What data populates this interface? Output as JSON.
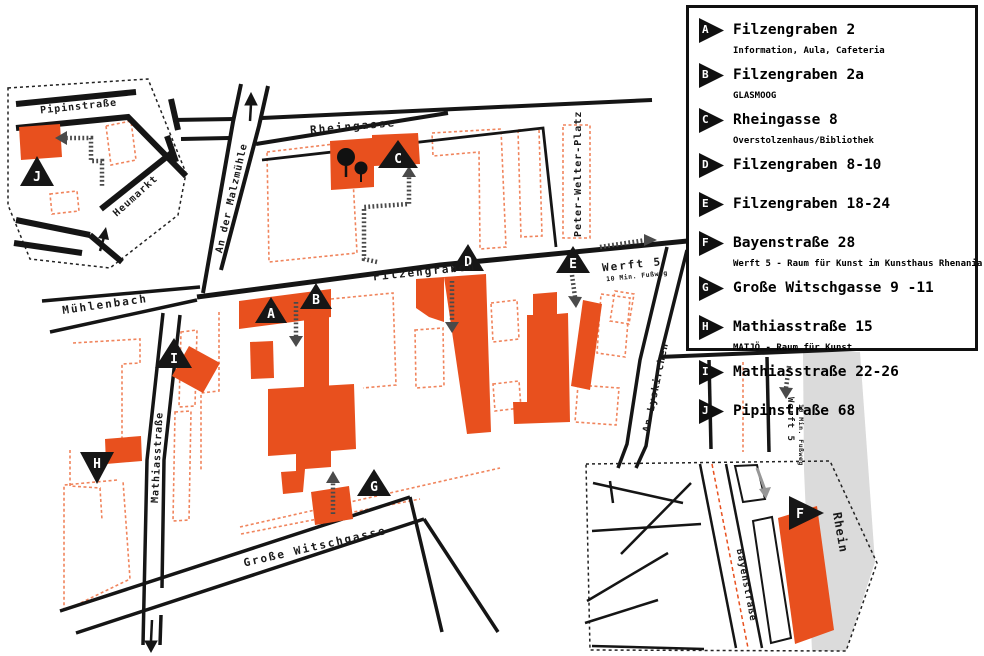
{
  "legend": {
    "items": [
      {
        "letter": "A",
        "title": "Filzengraben 2",
        "subtitle": "Information, Aula, Cafeteria"
      },
      {
        "letter": "B",
        "title": "Filzengraben 2a",
        "subtitle": "GLASMOOG"
      },
      {
        "letter": "C",
        "title": "Rheingasse 8",
        "subtitle": "Overstolzenhaus/Bibliothek"
      },
      {
        "letter": "D",
        "title": "Filzengraben 8-10",
        "subtitle": ""
      },
      {
        "letter": "E",
        "title": "Filzengraben 18-24",
        "subtitle": ""
      },
      {
        "letter": "F",
        "title": "Bayenstraße 28",
        "subtitle": "Werft 5 - Raum für Kunst im Kunsthaus Rhenania"
      },
      {
        "letter": "G",
        "title": "Große Witschgasse 9 -11",
        "subtitle": ""
      },
      {
        "letter": "H",
        "title": "Mathiasstraße 15",
        "subtitle": "MATJÖ - Raum für Kunst"
      },
      {
        "letter": "I",
        "title": "Mathiasstraße 22-26",
        "subtitle": ""
      },
      {
        "letter": "J",
        "title": "Pipinstraße 68",
        "subtitle": ""
      }
    ]
  },
  "map": {
    "streets": {
      "rheingasse": "Rheingasse",
      "an_der_malzmuehle": "An der Malzmühle",
      "filzengraben": "Filzengraben",
      "muehlenbach": "Mühlenbach",
      "mathiasstrasse": "Mathiasstraße",
      "grosse_witschgasse": "Große Witschgasse",
      "an_lyskirchen": "An Lyskirchen",
      "peter_welter_platz": "Peter-Welter-Platz",
      "heumarkt": "Heumarkt",
      "pipinstrasse": "Pipinstraße",
      "bayenstrasse": "Bayenstraße",
      "rhein": "Rhein"
    },
    "notes": {
      "werft": "Werft 5",
      "fussweg": "10 Min. Fußweg"
    },
    "colors": {
      "building": "#E8501E",
      "outline_dashed": "#F0845C",
      "street": "#151515",
      "rhein_band": "#DBDBDB",
      "arrow_gray": "#979797",
      "path_hatched": "#4A4A4A"
    }
  }
}
